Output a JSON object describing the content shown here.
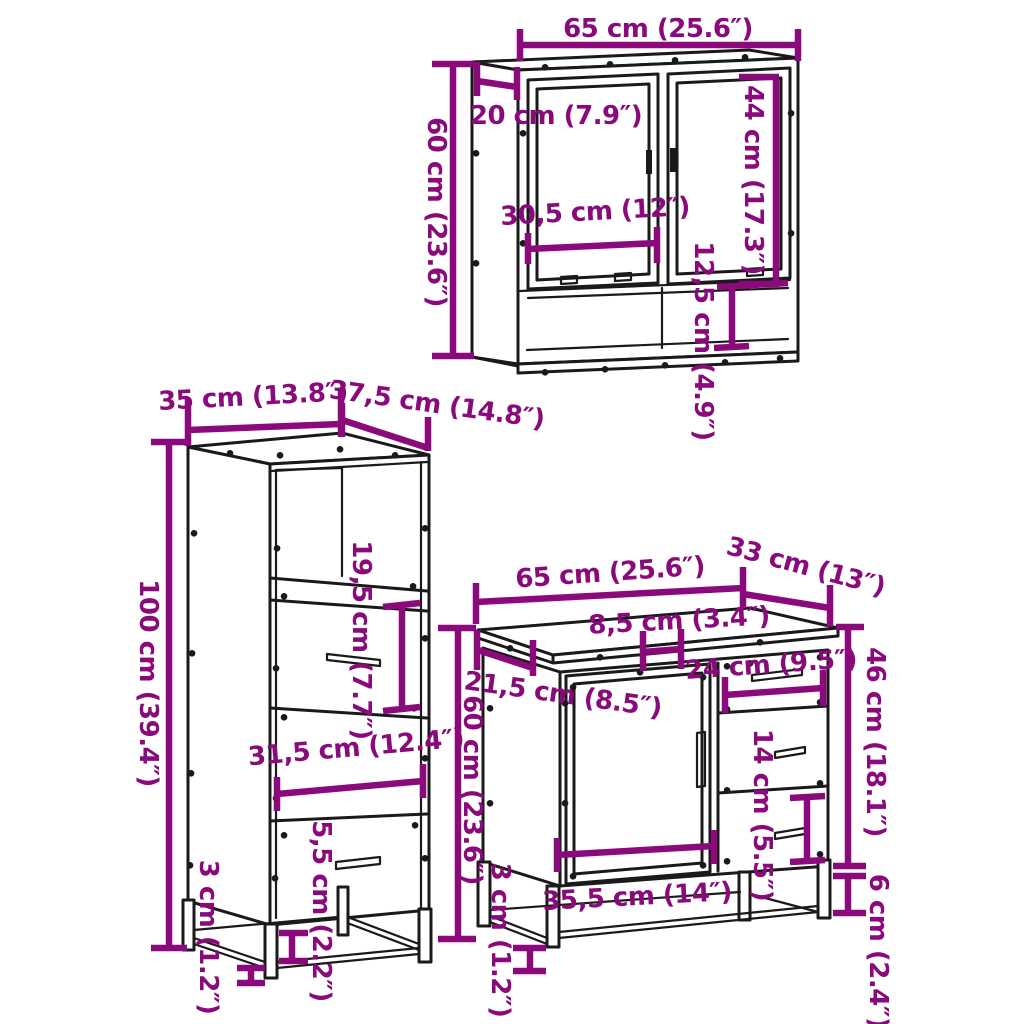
{
  "colors": {
    "dimension_lines": "#8a0a7c",
    "furniture_outline": "#1a1a1a",
    "background": "#ffffff"
  },
  "mirror_cabinet": {
    "labels": {
      "width": "65 cm (25.6″)",
      "depth": "20 cm (7.9″)",
      "height": "60 cm (23.6″)",
      "door_height": "44 cm (17.3″)",
      "door_width": "30,5 cm (12″)",
      "shelf_height": "12,5 cm (4.9″)"
    }
  },
  "tall_cabinet": {
    "labels": {
      "width": "35 cm (13.8″)",
      "depth": "37,5 cm (14.8″)",
      "height": "100 cm (39.4″)",
      "drawer_height": "19,5 cm (7.7″)",
      "inner_width": "31,5 cm (12.4″)",
      "base_height": "5,5 cm (2.2″)",
      "leg_height": "3 cm (1.2″)"
    }
  },
  "sink_cabinet": {
    "labels": {
      "width": "65 cm (25.6″)",
      "depth": "33 cm (13″)",
      "height": "60 cm (23.6″)",
      "side_height": "46 cm (18.1″)",
      "cutout_width": "8,5 cm (3.4″)",
      "top_depth": "21,5 cm (8.5″)",
      "drawer_width": "24 cm (9.5″)",
      "drawer_height": "14 cm (5.5″)",
      "door_width": "35,5 cm (14″)",
      "base_height": "6 cm (2.4″)",
      "leg_height": "3 cm (1.2″)"
    }
  }
}
